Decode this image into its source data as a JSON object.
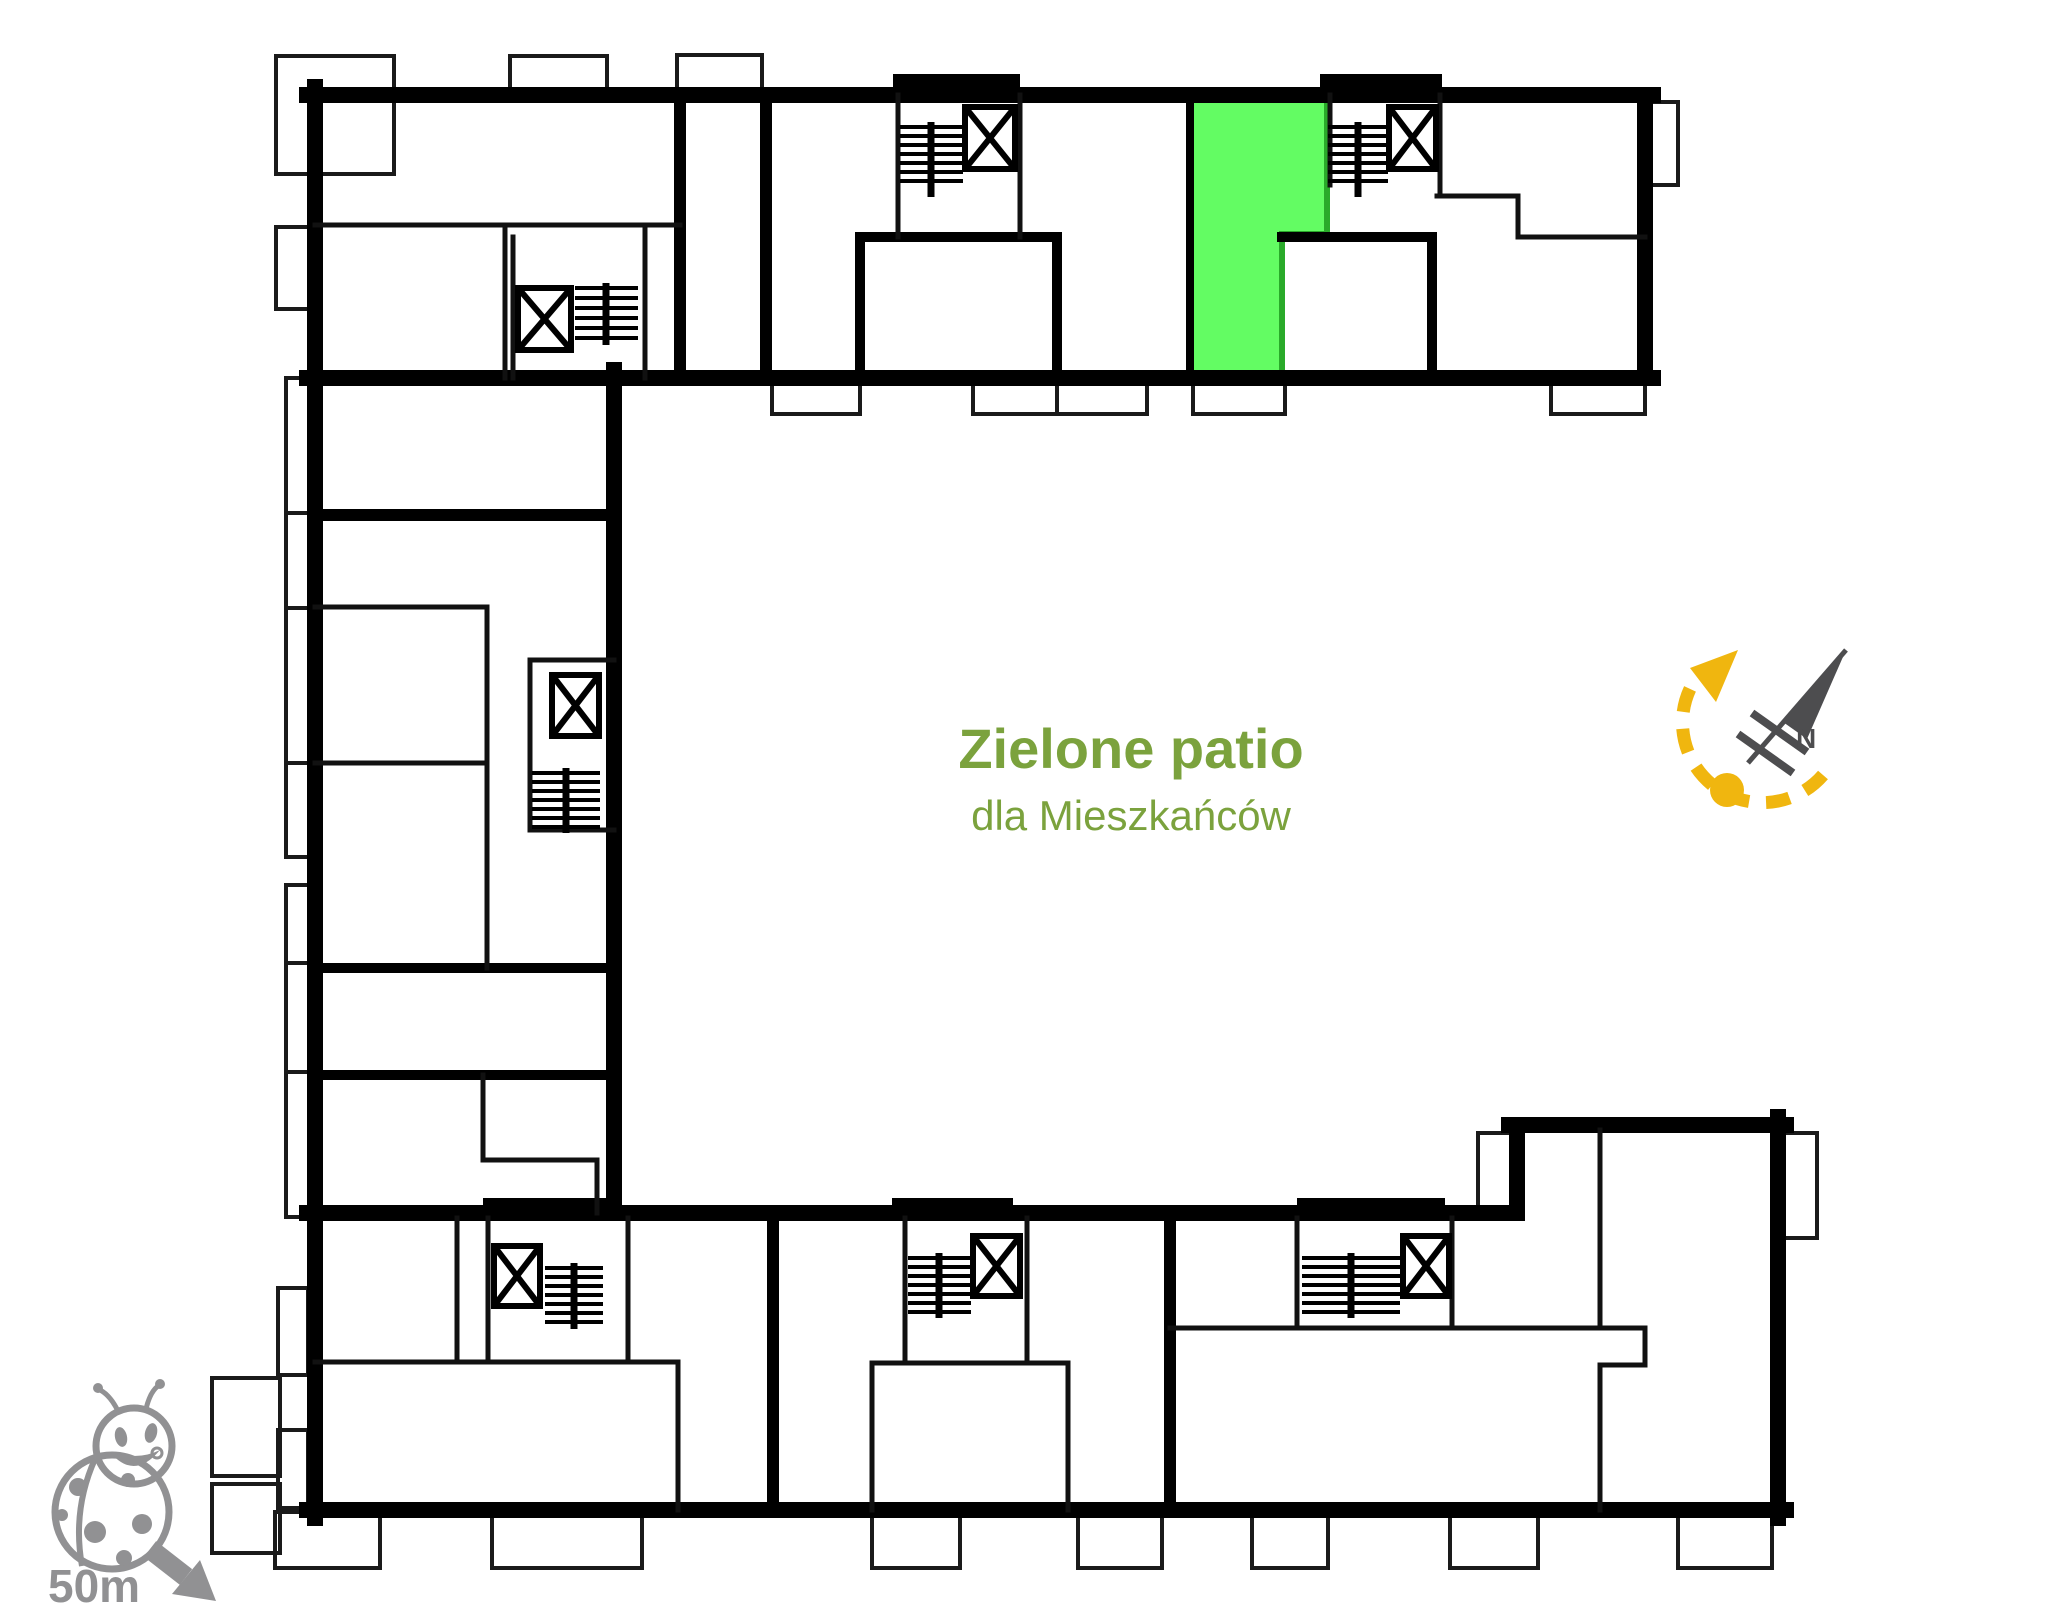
{
  "canvas": {
    "width": 2048,
    "height": 1623,
    "background": "#ffffff"
  },
  "patio": {
    "title": "Zielone patio",
    "subtitle": "dla Mieszkańców"
  },
  "compass": {
    "north_label": "N"
  },
  "scale_indicator": {
    "distance": "50m"
  },
  "colors": {
    "highlight_fill": "#63fc63",
    "highlight_border": "#2aaa2a",
    "patio_text": "#7ba23d",
    "compass_accent": "#f0b60f",
    "needle_gray": "#4d4d4f",
    "icon_gray": "#919193",
    "wall_black": "#000000"
  },
  "icons": [
    "ladybug-icon",
    "scale-arrow-icon",
    "compass-needle-icon",
    "compass-rotation-arc-icon",
    "elevator-icon",
    "stairs-icon"
  ]
}
